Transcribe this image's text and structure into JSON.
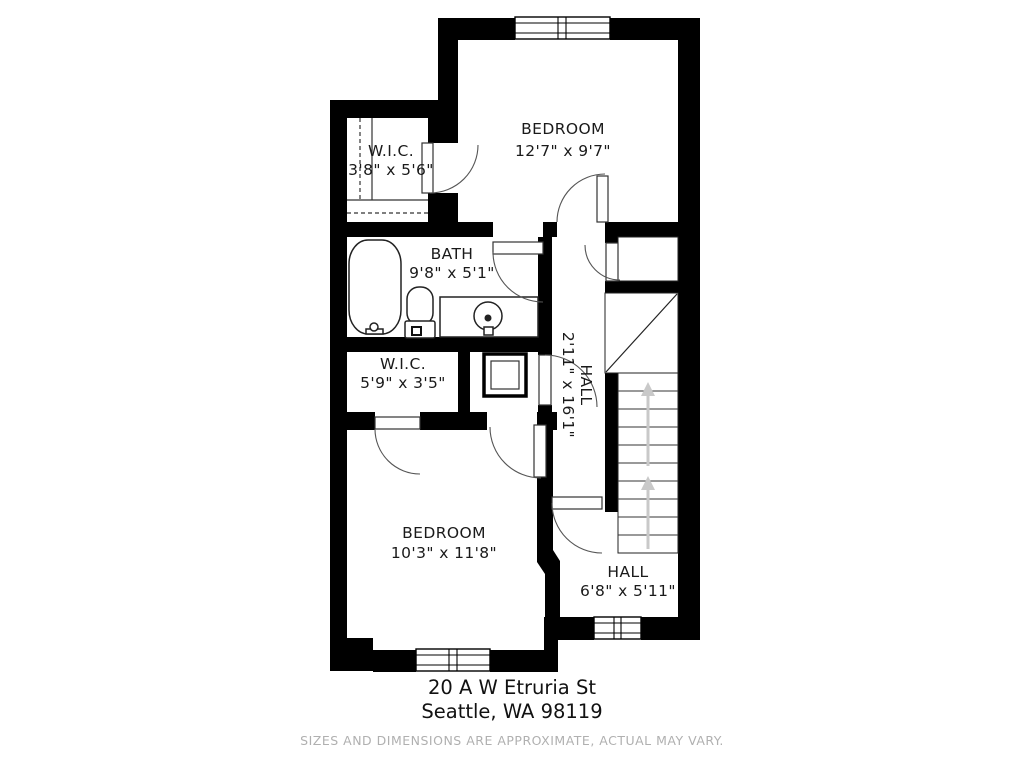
{
  "floorplan": {
    "rooms": [
      {
        "name": "W.I.C.",
        "dims": "3'8\" x 5'6\""
      },
      {
        "name": "BEDROOM",
        "dims": "12'7\" x 9'7\""
      },
      {
        "name": "BATH",
        "dims": "9'8\" x 5'1\""
      },
      {
        "name": "W.I.C.",
        "dims": "5'9\" x 3'5\""
      },
      {
        "name": "HALL",
        "dims": "2'11\" x 16'1\""
      },
      {
        "name": "BEDROOM",
        "dims": "10'3\" x 11'8\""
      },
      {
        "name": "HALL",
        "dims": "6'8\" x 5'11\""
      }
    ],
    "address_line1": "20 A W Etruria St",
    "address_line2": "Seattle, WA 98119",
    "disclaimer": "SIZES AND DIMENSIONS ARE APPROXIMATE, ACTUAL MAY VARY.",
    "colors": {
      "wall": "#000000",
      "label": "#1a1a1a",
      "disclaimer": "#b0b0b0",
      "stair_arrow": "#c9c9c9"
    }
  }
}
